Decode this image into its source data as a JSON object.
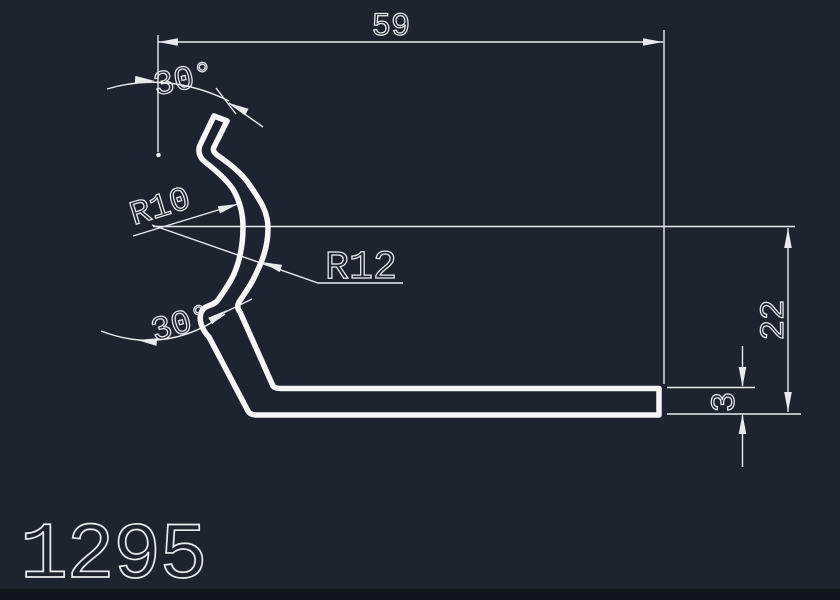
{
  "app": {
    "name": "CAD profile drawing",
    "background": "#1e2330",
    "line_color": "#e7ebef",
    "footer_bar_color": "#10141d"
  },
  "drawing": {
    "part_number": "1295",
    "dimensions": {
      "overall_width": "59",
      "overall_height": "22",
      "material_thickness": "3",
      "top_bend_angle": "30°",
      "bottom_bend_angle": "30°",
      "inner_radius": "R10",
      "outer_radius": "R12"
    }
  }
}
